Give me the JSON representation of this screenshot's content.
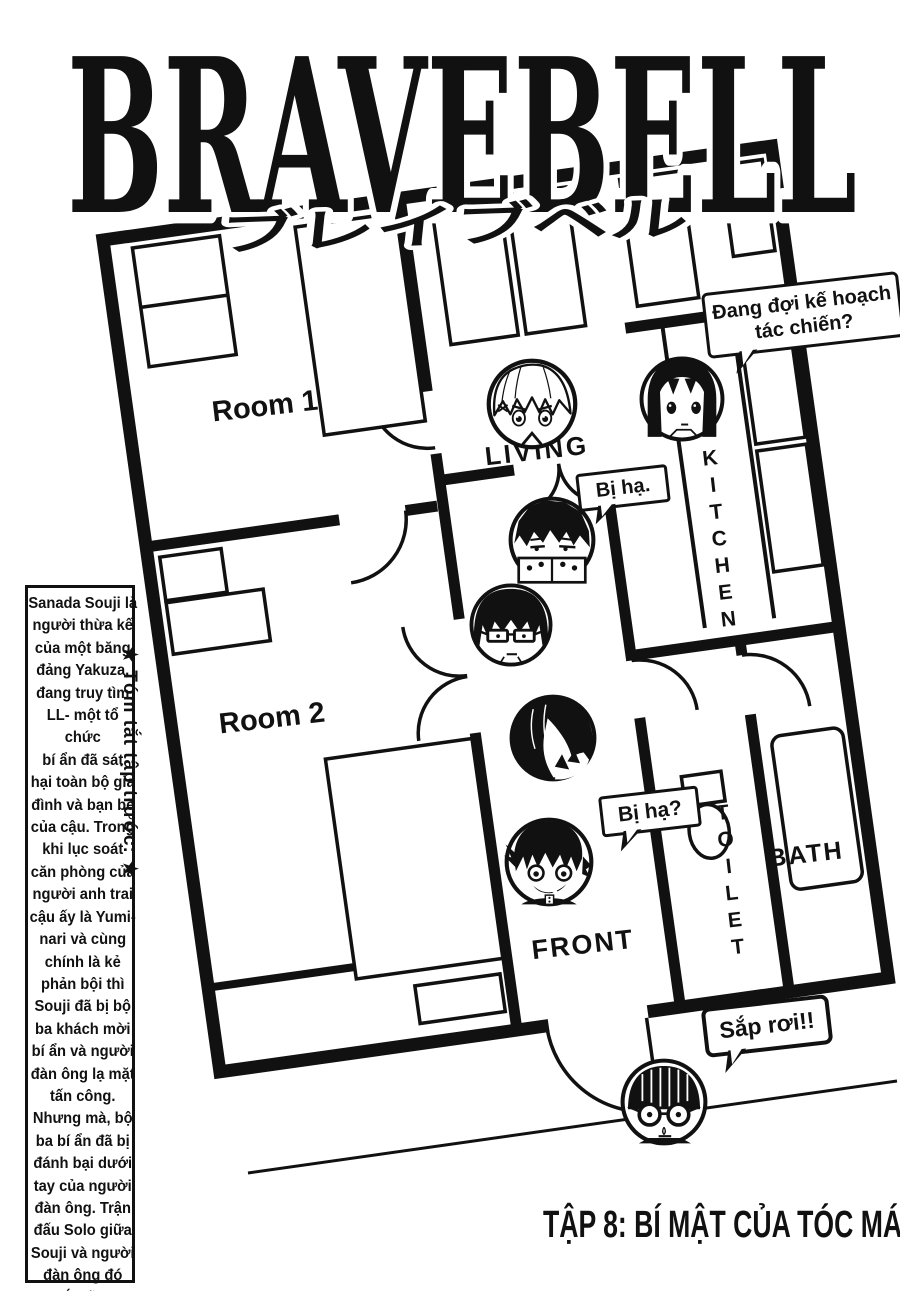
{
  "page": {
    "title": "BRAVEBELL",
    "title_katakana": "ブレイブベル",
    "chapter_title": "TẬP 8: BÍ MẬT CỦA TÓC MÁI.",
    "ink_color": "#111111",
    "paper_color": "#ffffff"
  },
  "floorplan": {
    "room1": "Room 1",
    "room2": "Room 2",
    "living": "LIVING",
    "kitchen": "KITCHEN",
    "toilet": "TOILET",
    "bath": "BATH",
    "front": "FRONT"
  },
  "bubbles": {
    "waiting_plan": "Đang đợi kế hoạch tác chiến?",
    "defeated_statement": "Bị hạ.",
    "defeated_question": "Bị hạ?",
    "falling": "Sắp rơi!!"
  },
  "recap": {
    "vertical_label": "★ Tóm tắt tập trước: ★",
    "lines": [
      "Sanada Souji là",
      "người thừa kế",
      "của một băng",
      "đảng Yakuza,",
      "đang truy tìm",
      "LL- một tổ chức",
      "bí ẩn đã sát",
      "hại toàn bộ gia",
      "đình và bạn bè",
      "của cậu. Trong",
      "khi lục soát",
      "căn phòng của",
      "người anh trai",
      "cậu ấy là Yumi-",
      "nari và cùng",
      "chính là kẻ",
      "phản bội thì",
      "Souji đã bị bộ",
      "ba khách mời",
      "bí ẩn và người",
      "đàn ông lạ mặt",
      "tấn công.",
      "Nhưng mà, bộ",
      "ba bí ẩn đã bị",
      "đánh bại dưới",
      "tay của người",
      "đàn ông. Trận",
      "đấu Solo giữa",
      "Souji và người",
      "đàn ông đó",
      "bắt đầu."
    ]
  },
  "character_icons": [
    "white-haired-girl-icon",
    "long-black-haired-girl-icon",
    "masked-collar-boy-icon",
    "glasses-boy-icon",
    "bangs-covered-face-icon",
    "fang-grin-girl-icon",
    "goggles-kid-icon"
  ]
}
